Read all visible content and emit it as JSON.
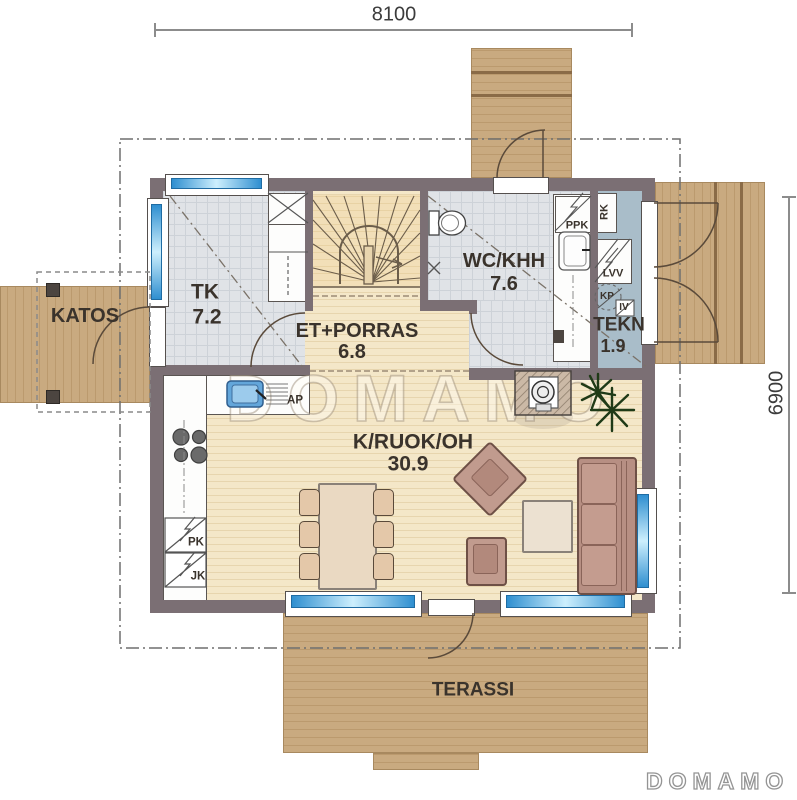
{
  "dimensions": {
    "top": "8100",
    "right": "6900"
  },
  "watermark": "DOMAMO",
  "logo": "DOMAMO",
  "rooms": {
    "katos": {
      "name": "KATOS"
    },
    "tk": {
      "name": "TK",
      "area": "7.2"
    },
    "et": {
      "name": "ET+PORRAS",
      "area": "6.8"
    },
    "wc": {
      "name": "WC/KHH",
      "area": "7.6"
    },
    "tekn": {
      "name": "TEKN",
      "area": "1.9"
    },
    "living": {
      "name": "K/RUOK/OH",
      "area": "30.9"
    },
    "terassi": {
      "name": "TERASSI"
    }
  },
  "appliances": {
    "ppk": "PPK",
    "rk": "RK",
    "lvv": "LVV",
    "kp": "KP",
    "iv": "IV",
    "ap": "AP",
    "pk": "PK",
    "jk": "JK"
  },
  "colors": {
    "wall": "#7b6f74",
    "deck_wood": "#c9aa80",
    "interior_wood": "#f4e7c8",
    "tile": "#e0e3e7",
    "tekn_floor": "#a9bdc9",
    "window_glass": "#2f8fd0",
    "furniture": "#b78f83",
    "plant": "#1f3a17"
  }
}
